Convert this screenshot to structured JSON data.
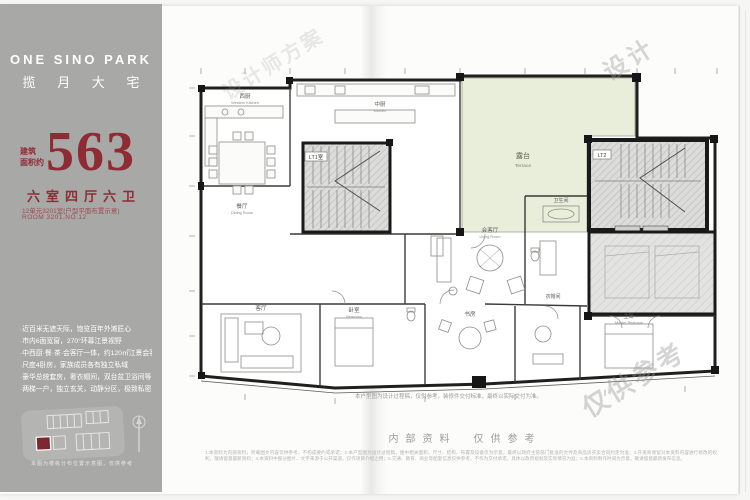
{
  "brand": {
    "name_en": "ONE SINO PARK",
    "name_cn": "揽 月 大 宅"
  },
  "area": {
    "prefix_line1": "建筑",
    "prefix_line2": "面积约",
    "value": "563",
    "rooms": "六室四厅六卫",
    "unit_line1": "12单元3201室(户型平面布置示意)",
    "unit_line2": "ROOM 3201,NO.12"
  },
  "features": [
    "·近百米无遮天际，饱览百年外滩匠心",
    "·市内6面宽窗，270°环幕江景视野",
    "·中西厨·餐·茶·会客厅一体，约120㎡江景会客厅",
    "·尺度4卧房，家族成员各有独立私域",
    "·豪华总统套房，奢衣帽间，双台盆卫浴间等",
    "·两梯一户，独立玄关，动静分区，极致私密"
  ],
  "sitemap": {
    "caption": "本图为楼栋分布位置示意图，仅供参考",
    "highlight_color": "#7e2730"
  },
  "plan": {
    "rooms": [
      {
        "cn": "西厨",
        "en": "Western Kitchen"
      },
      {
        "cn": "餐厅",
        "en": "Dining Room"
      },
      {
        "cn": "中厨",
        "en": "Kitchen"
      },
      {
        "cn": "露台",
        "en": "Terrace"
      },
      {
        "cn": "LT1室",
        "en": ""
      },
      {
        "cn": "LT2",
        "en": ""
      },
      {
        "cn": "会客厅",
        "en": "Living Room"
      },
      {
        "cn": "客厅",
        "en": "Sitting Room"
      },
      {
        "cn": "卧室",
        "en": "Bedroom"
      },
      {
        "cn": "书房",
        "en": "Study"
      },
      {
        "cn": "主卧",
        "en": "Master Bedroom"
      },
      {
        "cn": "卫生间",
        "en": "Bathroom"
      },
      {
        "cn": "衣帽间",
        "en": "Cloakroom"
      }
    ],
    "caption": "本户型图为设计过程稿，仅供参考，装修件交付标准，最终以实际交付为准。",
    "watermark_a": "设计",
    "watermark_b": "仅供参考",
    "watermark_c": "设计师方案"
  },
  "footer": {
    "notice": "内部资料　仅供参考",
    "disclaimer": "1.本资料为内部资料，所载图文内容仅供参考，不构成要约或承诺；2.本户型图为设计过程稿，图中相关面积、尺寸、结构、布置及设备仅为示意，最终以政府主管部门批准的文件及商品房买卖合同约定为准；3.开发商保留对本资料内容进行修改的权利，敬请留意最新资料；4.本资料中部分图片、文字来源于公开渠道，仅作项目介绍之用；5.交通、教育、商业等配套信息仅供参考，不作为交付承诺，具体以政府规划及实际情况为准；6.本资料制作时间为示意，敬请留意最新发布信息。"
  },
  "colors": {
    "accent": "#8e2b33",
    "panel": "#a8a8a6",
    "terrace": "#e9eedb"
  }
}
